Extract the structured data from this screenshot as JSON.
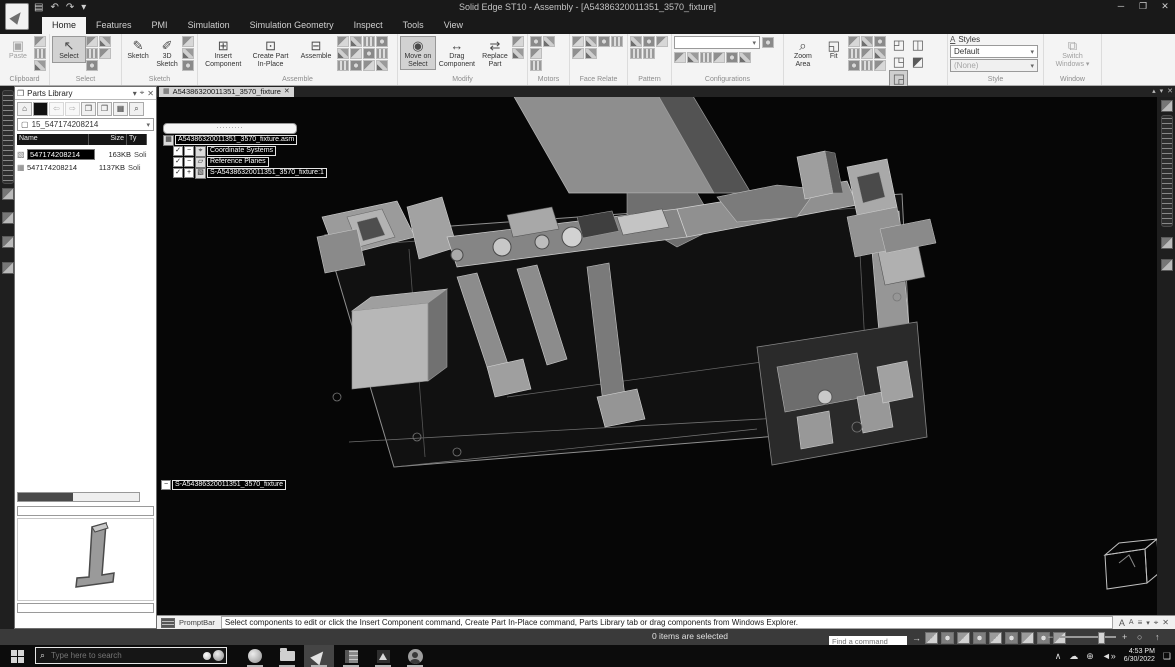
{
  "icons": {
    "save": "▤",
    "undo": "↶",
    "redo": "↷",
    "dropdown": "▾",
    "minimize": "─",
    "restore": "❐",
    "close": "✕",
    "paste": "▣",
    "cut": "✂",
    "copy": "⧉",
    "select": "↖",
    "sketch": "✎",
    "sketch3d": "✐",
    "insert_component": "⊞",
    "create_part": "⊡",
    "assemble": "⊟",
    "move_on_select": "◉",
    "drag_component": "↔",
    "replace_part": "⇄",
    "zoom_area": "⌕",
    "fit": "◱",
    "cube1": "◰",
    "cube2": "◫",
    "cube3": "◳",
    "cube4": "◲",
    "cube5": "◩",
    "styles_a": "A",
    "switch_windows": "⧉",
    "panel_folder": "❒",
    "panel_menu": "▾",
    "panel_pin": "⌖",
    "panel_close": "✕",
    "home": "⌂",
    "back": "⇦",
    "forward": "⇨",
    "folder": "❒",
    "folder2": "❐",
    "views": "▦",
    "search": "⌕",
    "doc": "▢",
    "tree_root": "▦",
    "tree_csys": "⌖",
    "tree_plane": "▱",
    "tree_part": "▧",
    "check": "✓",
    "collapse": "−",
    "expand": "+",
    "font_up": "A",
    "font_down": "A",
    "autohide": "≡",
    "pin": "⌖",
    "status_arrow": "→",
    "zoom_out": "−",
    "zoom_in": "+",
    "circle": "○",
    "lift": "↑",
    "tray_up": "∧",
    "tray_cloud": "☁",
    "tray_net": "⊕",
    "tray_vol": "◄»",
    "tray_chat": "❑",
    "tab_up": "▴",
    "tab_down": "▾"
  },
  "titlebar": {
    "title": "Solid Edge ST10 - Assembly - [A54386320011351_3570_fixture]"
  },
  "ribbon_tabs": [
    {
      "label": "Home"
    },
    {
      "label": "Features"
    },
    {
      "label": "PMI"
    },
    {
      "label": "Simulation"
    },
    {
      "label": "Simulation Geometry"
    },
    {
      "label": "Inspect"
    },
    {
      "label": "Tools"
    },
    {
      "label": "View"
    }
  ],
  "ribbon": {
    "clipboard": {
      "group": "Clipboard",
      "paste": "Paste"
    },
    "select": {
      "group": "Select",
      "select": "Select"
    },
    "sketch": {
      "group": "Sketch",
      "sketch": "Sketch",
      "sketch_3d": "3D Sketch"
    },
    "assemble": {
      "group": "Assemble",
      "insert_component": "Insert Component",
      "create_part": "Create Part In-Place",
      "assemble": "Assemble"
    },
    "modify": {
      "group": "Modify",
      "move_on_select": "Move on Select",
      "drag_component": "Drag Component",
      "replace_part": "Replace Part"
    },
    "motors": {
      "group": "Motors"
    },
    "face_relate": {
      "group": "Face Relate"
    },
    "pattern": {
      "group": "Pattern"
    },
    "configurations": {
      "group": "Configurations"
    },
    "orient": {
      "group": "Orient",
      "zoom_area": "Zoom Area",
      "fit": "Fit"
    },
    "style": {
      "group": "Style",
      "styles": "Styles",
      "style_value": "Default",
      "view_style_value": "(None)"
    },
    "window_group": {
      "group": "Window",
      "switch_windows": "Switch Windows"
    }
  },
  "parts_library": {
    "title": "Parts Library",
    "folder": "15_547174208214",
    "columns": {
      "name": "Name",
      "size": "Size",
      "type": "Ty"
    },
    "items": [
      {
        "name": "547174208214",
        "size": "163KB",
        "type": "Soli"
      },
      {
        "name": "547174208214",
        "size": "1137KB",
        "type": "Soli"
      }
    ]
  },
  "document": {
    "tab": "A54386320011351_3570_fixture",
    "pathfinder": {
      "search_dots": "·········",
      "root": "A54386320011351_3570_fixture.asm",
      "nodes": [
        {
          "label": "Coordinate Systems"
        },
        {
          "label": "Reference Planes"
        },
        {
          "label": "S-A54386320011351_3570_fixture:1"
        }
      ],
      "footer": "S-A54386320011351_3570_fixture"
    }
  },
  "promptbar": {
    "label": "PromptBar",
    "message": "Select components to edit or click the Insert Component command, Create Part In-Place command, Parts Library tab or drag components from Windows Explorer."
  },
  "statusbar": {
    "selection": "0 items are selected",
    "find_placeholder": "Find a command"
  },
  "taskbar": {
    "search_placeholder": "Type here to search",
    "time": "4:53 PM",
    "date": "6/30/2022"
  }
}
